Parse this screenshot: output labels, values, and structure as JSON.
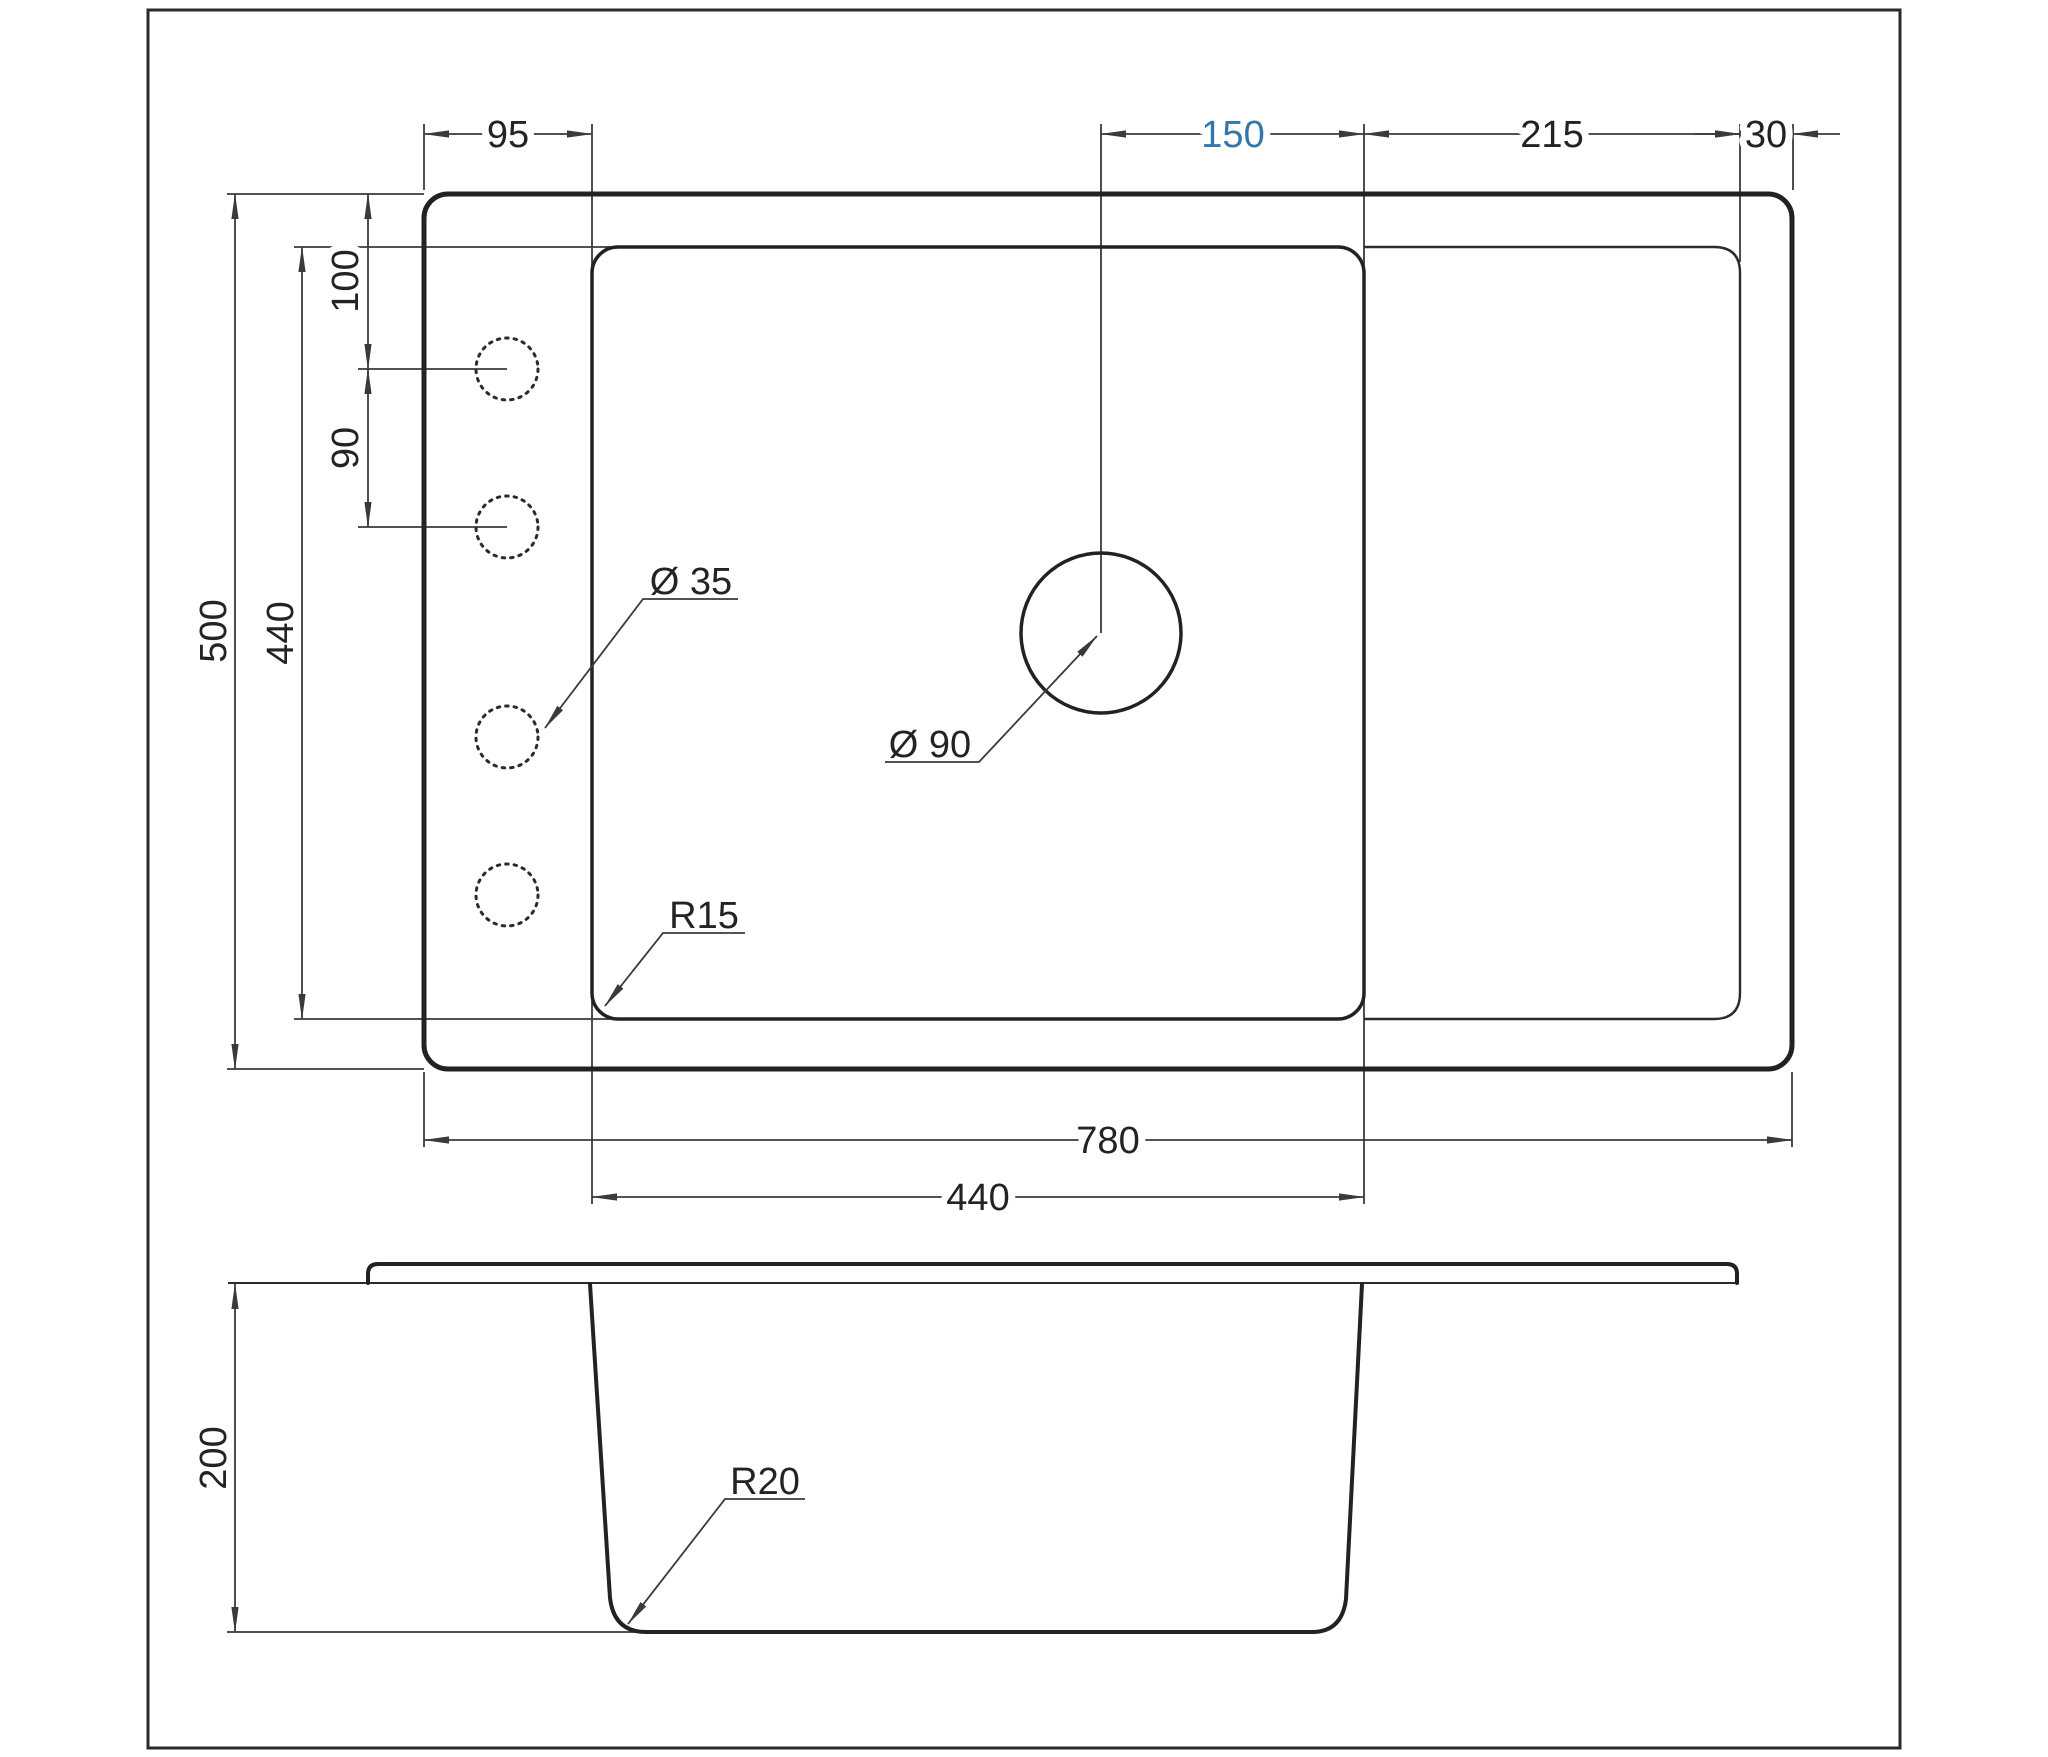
{
  "drawing": {
    "title": "sink-dimension-drawing",
    "colors": {
      "line": "#222222",
      "accent_blue": "#3377aa",
      "background": "#ffffff"
    },
    "top_view": {
      "dim_left_ledge_width": "95",
      "dim_drain_to_bowl_right": "150",
      "dim_drainboard_width": "215",
      "dim_right_margin": "30",
      "dim_top_to_hole1": "100",
      "dim_hole_spacing": "90",
      "dim_overall_depth": "500",
      "dim_bowl_depth": "440",
      "dim_overall_width": "780",
      "dim_bowl_width": "440",
      "label_faucet_hole_diameter": "Ø 35",
      "label_drain_diameter": "Ø 90",
      "label_bowl_corner_radius": "R15"
    },
    "section_view": {
      "dim_bowl_height": "200",
      "label_bottom_corner_radius": "R20"
    }
  }
}
